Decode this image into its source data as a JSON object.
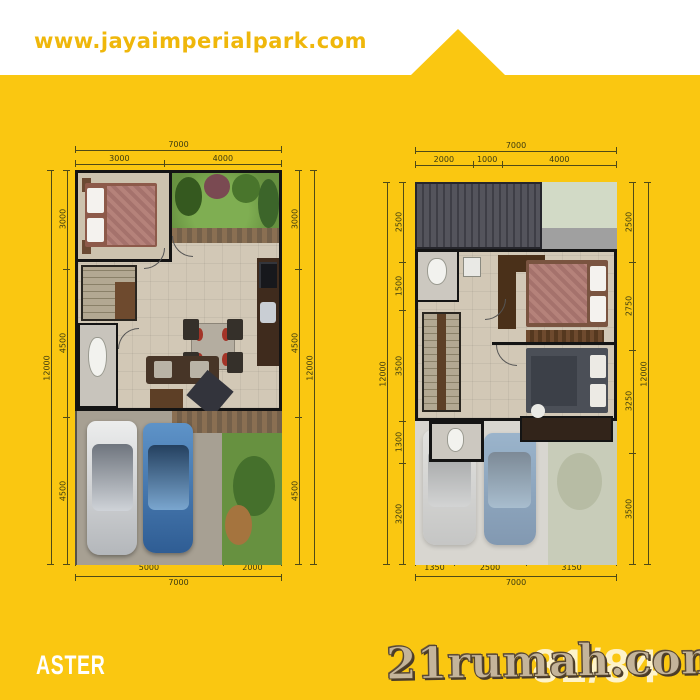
{
  "header": {
    "website_url": "www.jayaimperialpark.com"
  },
  "footer": {
    "unit_name": "ASTER",
    "unit_type": "81/84",
    "watermark": "21rumah.com"
  },
  "colors": {
    "bg": "#FAC711",
    "band": "#FFFFFF",
    "url-text": "#EFB70B",
    "dim-line": "#4F4A17",
    "dim-text": "#3B3A10",
    "wall": "#141414",
    "floor-tile": "#D2C8B6",
    "garden-green": "#679140",
    "roof-gray": "#47474F",
    "carport-gray": "#A7A093",
    "car-silver": "#D2D3D5",
    "car-blue": "#4A7FB5",
    "watermark-fill": "#C4B49A",
    "watermark-outline": "#55452F",
    "unit-name-color": "#FFFFFF"
  },
  "plans": {
    "ground": {
      "dims_top": {
        "total": "7000",
        "segments": [
          "3000",
          "4000"
        ]
      },
      "dims_bottom": {
        "total": "7000",
        "segments": [
          "5000",
          "2000"
        ]
      },
      "dims_left": {
        "total": "12000",
        "segments": [
          "3000",
          "4500",
          "4500"
        ]
      },
      "dims_right": {
        "total": "12000",
        "segments": [
          "3000",
          "4500",
          "4500"
        ]
      }
    },
    "upper": {
      "dims_top": {
        "total": "7000",
        "segments": [
          "2000",
          "1000",
          "4000"
        ]
      },
      "dims_bottom": {
        "total": "7000",
        "segments": [
          "1350",
          "2500",
          "3150"
        ]
      },
      "dims_left": {
        "total": "12000",
        "segments": [
          "2500",
          "1500",
          "3500",
          "1300",
          "3200"
        ]
      },
      "dims_right": {
        "total": "12000",
        "segments": [
          "2500",
          "2750",
          "3250",
          "3500"
        ]
      }
    }
  }
}
